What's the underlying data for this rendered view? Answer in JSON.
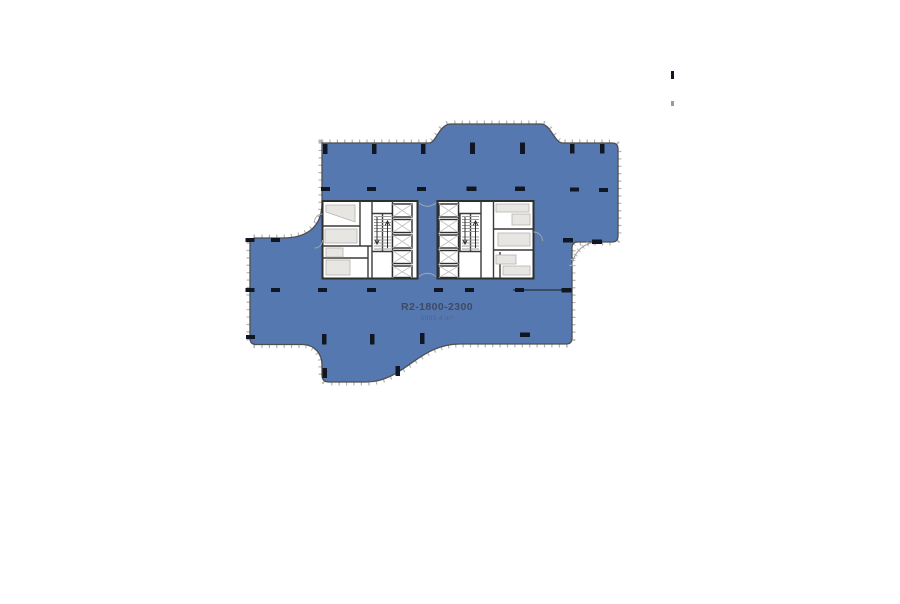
{
  "floorplan": {
    "unit_label": "R2-1800-2300",
    "area_label": "5005.4 m²",
    "colors": {
      "floor_fill": "#5578b1",
      "floor_outline": "#4e4e4e",
      "mullion_tick": "#b3b3b3",
      "column": "#111722",
      "core_wall": "#2e2e2e",
      "room_fill": "#ffffff",
      "fixture_fill": "#e8e6e2",
      "stair_tread": "#9c9c9c",
      "elevator_x": "#c2c2c2",
      "label_text": "#3e4a61"
    },
    "shapes": [
      {
        "tag": "path",
        "attrs": {
          "d": "M322 143H429C436 143 439 125 450 124H541C551 124 554 143 563 143H612Q618 143 618 149V236Q618 242 612 242H578Q572 242 572 248V338Q572 344 566 344H460C418 344 404 382 366 382H329Q322 382 322 375V365C322 354 315 345 303 344.5H256Q250 344.5 250 338V244Q250 238 256 238H283C303 238 322 230 322 203Z",
          "fill": "none",
          "stroke": "#b3b3b3",
          "stroke-width": "7",
          "stroke-dasharray": "1.2 6.2",
          "data-name": "facade-mullion-ticks",
          "data-interactable": "false"
        }
      },
      {
        "tag": "path",
        "attrs": {
          "d": "M322 143H429C436 143 439 125 450 124H541C551 124 554 143 563 143H612Q618 143 618 149V236Q618 242 612 242H578Q572 242 572 248V338Q572 344 566 344H460C418 344 404 382 366 382H329Q322 382 322 375V365C322 354 315 345 303 344.5H256Q250 344.5 250 338V244Q250 238 256 238H283C303 238 322 230 322 203Z",
          "fill": "#5578b1",
          "stroke": "#4e4e4e",
          "stroke-width": "1.3",
          "data-name": "floor-region",
          "data-interactable": "true"
        }
      },
      {
        "tag": "path",
        "attrs": {
          "d": "M572 266A26 26 0 0 1 598 242",
          "fill": "none",
          "stroke": "#bdbdbd",
          "stroke-width": "5",
          "stroke-dasharray": "1 4.6",
          "data-name": "setback-arc-ticks",
          "data-interactable": "false"
        }
      },
      {
        "tag": "path",
        "attrs": {
          "d": "M572 266A26 26 0 0 1 598 242",
          "fill": "none",
          "stroke": "#9a9a9a",
          "stroke-width": "1",
          "data-name": "setback-arc",
          "data-interactable": "false"
        }
      },
      {
        "tag": "path",
        "attrs": {
          "d": "M513 290H572",
          "fill": "none",
          "stroke": "#2f3a4e",
          "stroke-width": "1.4",
          "data-name": "partition-line",
          "data-interactable": "false"
        }
      },
      {
        "tag": "rect",
        "attrs": {
          "x": "322.5",
          "y": "201",
          "width": "95",
          "height": "77.5",
          "fill": "#ffffff",
          "stroke": "#2e2e2e",
          "stroke-width": "2",
          "data-name": "core-left-block",
          "data-interactable": "false"
        }
      },
      {
        "tag": "rect",
        "attrs": {
          "x": "437.5",
          "y": "201",
          "width": "96",
          "height": "77.5",
          "fill": "#ffffff",
          "stroke": "#2e2e2e",
          "stroke-width": "2",
          "data-name": "core-right-block",
          "data-interactable": "false"
        }
      },
      {
        "tag": "path",
        "attrs": {
          "d": "M360 201V246M322.5 226H360M322.5 246H372M368 246V278.5M322.5 258H368M372 201V278.5M392.5 201V278.5M372 213.5H392.5V251.5H372ZM382.5 214V251.5",
          "fill": "none",
          "stroke": "#3a3a3a",
          "stroke-width": "1.4",
          "data-name": "core-left-walls",
          "data-interactable": "false"
        }
      },
      {
        "tag": "path",
        "attrs": {
          "d": "M458.5 201V278.5M481 201V278.5M460 213.5H481V251.5H460ZM470.5 214V251.5M493.5 201V278.5M493.5 229H533.5M493.5 250H533.5M500 252V278.5",
          "fill": "none",
          "stroke": "#3a3a3a",
          "stroke-width": "1.4",
          "data-name": "core-right-walls",
          "data-interactable": "false"
        }
      },
      {
        "tag": "path",
        "attrs": {
          "d": "M326 205H355V222L326 212Z",
          "fill": "#e8e6e2",
          "stroke": "#b6b3ac",
          "stroke-width": "0.8",
          "data-name": "mechanical-room-equipment",
          "data-interactable": "false"
        }
      },
      {
        "tag": "rects",
        "attrs": {
          "fill": "#e8e6e2",
          "stroke": "#b6b3ac",
          "stroke-width": "0.8",
          "data-name": "room-fixture",
          "data-interactable": "false"
        },
        "items": [
          [
            325,
            229,
            32,
            14
          ],
          [
            326,
            248,
            17,
            9
          ],
          [
            326,
            260,
            24,
            15
          ],
          [
            496,
            204,
            33,
            8
          ],
          [
            512,
            214,
            18,
            11
          ],
          [
            498,
            233,
            32,
            13
          ],
          [
            496,
            255,
            20,
            9
          ],
          [
            503,
            266,
            27,
            9
          ]
        ]
      },
      {
        "tag": "path",
        "attrs": {
          "d": "M374 216.5H391M374 219.5H391M374 222.5H391M374 225.5H391M374 228.5H391M374 231.5H391M374 237H391M374 240H391M374 243H391M374 246H391M374 249H391",
          "fill": "none",
          "stroke": "#9c9c9c",
          "stroke-width": "0.9",
          "data-name": "stair-treads-left",
          "data-interactable": "false"
        }
      },
      {
        "tag": "path",
        "attrs": {
          "d": "M462 216.5H479M462 219.5H479M462 222.5H479M462 225.5H479M462 228.5H479M462 231.5H479M462 237H479M462 240H479M462 243H479M462 246H479M462 249H479",
          "fill": "none",
          "stroke": "#9c9c9c",
          "stroke-width": "0.9",
          "data-name": "stair-treads-right",
          "data-interactable": "false"
        }
      },
      {
        "tag": "rects",
        "attrs": {
          "fill": "#ffffff",
          "stroke": "#2e2e2e",
          "stroke-width": "1.4",
          "data-name": "elevator-shaft",
          "data-interactable": "false"
        },
        "items": [
          [
            392.5,
            204,
            19.5,
            13
          ],
          [
            392.5,
            219.5,
            19.5,
            13
          ],
          [
            392.5,
            235,
            19.5,
            13
          ],
          [
            392.5,
            250.5,
            19.5,
            13
          ],
          [
            392.5,
            266,
            19.5,
            11.5
          ],
          [
            439,
            204,
            19.5,
            13
          ],
          [
            439,
            219.5,
            19.5,
            13
          ],
          [
            439,
            235,
            19.5,
            13
          ],
          [
            439,
            250.5,
            19.5,
            13
          ],
          [
            439,
            266,
            19.5,
            11.5
          ]
        ]
      },
      {
        "tag": "path",
        "attrs": {
          "d": "M392.5 204L412 217M412 204L392.5 217M392.5 219.5L412 232.5M412 219.5L392.5 232.5M392.5 235L412 248M412 235L392.5 248M392.5 250.5L412 263.5M412 250.5L392.5 263.5M392.5 266L412 277.5M412 266L392.5 277.5",
          "fill": "none",
          "stroke": "#c2c2c2",
          "stroke-width": "0.9",
          "data-name": "elevator-x-marks-left",
          "data-interactable": "false"
        }
      },
      {
        "tag": "path",
        "attrs": {
          "d": "M439 204L458.5 217M458.5 204L439 217M439 219.5L458.5 232.5M458.5 219.5L439 232.5M439 235L458.5 248M458.5 235L439 248M439 250.5L458.5 263.5M458.5 250.5L439 263.5M439 266L458.5 277.5M458.5 266L439 277.5",
          "fill": "none",
          "stroke": "#c2c2c2",
          "stroke-width": "0.9",
          "data-name": "elevator-x-marks-right",
          "data-interactable": "false"
        }
      },
      {
        "tag": "path",
        "attrs": {
          "d": "M377 217V243.5M374.8 239.8L377 244L379.2 239.8M387.5 248V221.5M385.3 225.2L387.5 221L389.7 225.2M465 217V243.5M462.8 239.8L465 244L467.2 239.8M475.5 248V221.5M473.3 225.2L475.5 221L477.7 225.2",
          "fill": "none",
          "stroke": "#2c2c2c",
          "stroke-width": "1",
          "data-name": "stair-direction-arrows",
          "data-interactable": "false"
        }
      },
      {
        "tag": "path",
        "attrs": {
          "d": "M419 203Q427.5 209.5 436 203M419 276.5Q427.5 270 436 276.5M322.5 214A8 8 0 0 0 314.5 222M322.5 240A8 8 0 0 1 314.5 248M533.5 232A9 9 0 0 1 542.5 241",
          "fill": "none",
          "stroke": "#a8a8a8",
          "stroke-width": "0.9",
          "data-name": "door-swing-arcs",
          "data-interactable": "false"
        }
      },
      {
        "tag": "rects",
        "attrs": {
          "fill": "#111722",
          "data-name": "column-marker",
          "data-interactable": "false"
        },
        "items": [
          [
            323,
            144,
            4.5,
            10
          ],
          [
            372,
            144,
            4.5,
            10
          ],
          [
            421,
            144,
            4.5,
            10
          ],
          [
            470,
            142.5,
            5,
            11.5
          ],
          [
            520,
            142.5,
            5,
            11.5
          ],
          [
            570,
            144,
            4.5,
            9.5
          ],
          [
            600,
            144,
            4.5,
            9.5
          ],
          [
            321,
            187,
            9,
            4
          ],
          [
            367,
            187,
            9,
            4
          ],
          [
            417,
            187,
            9,
            4
          ],
          [
            466.5,
            186.5,
            10,
            4.5
          ],
          [
            515,
            186.5,
            10,
            4.5
          ],
          [
            570,
            187.5,
            9,
            4
          ],
          [
            599,
            188,
            9,
            4
          ],
          [
            245.5,
            238,
            9,
            4
          ],
          [
            271,
            238,
            9,
            4
          ],
          [
            563,
            238,
            10,
            4.5
          ],
          [
            592,
            239.5,
            10,
            4.5
          ],
          [
            245.5,
            288,
            9,
            4
          ],
          [
            271,
            288,
            9,
            4
          ],
          [
            318,
            288,
            9,
            4
          ],
          [
            367,
            288,
            9,
            4
          ],
          [
            434,
            288,
            9,
            4
          ],
          [
            465,
            288,
            9,
            4
          ],
          [
            515,
            288,
            9,
            4
          ],
          [
            561.5,
            288,
            10,
            4.5
          ],
          [
            246,
            335,
            9,
            4
          ],
          [
            520,
            332.5,
            10,
            4.5
          ],
          [
            322,
            334,
            4.5,
            10.5
          ],
          [
            370,
            334,
            4.5,
            10.5
          ],
          [
            420,
            333,
            4.5,
            11
          ],
          [
            322.5,
            368,
            4.5,
            10
          ],
          [
            395.5,
            366,
            4.5,
            10
          ],
          [
            671,
            71,
            3,
            8
          ]
        ]
      },
      {
        "tag": "rect",
        "attrs": {
          "x": "671",
          "y": "101",
          "width": "3",
          "height": "5",
          "fill": "#9a9a9a",
          "data-name": "stray-mark",
          "data-interactable": "false"
        }
      }
    ]
  }
}
